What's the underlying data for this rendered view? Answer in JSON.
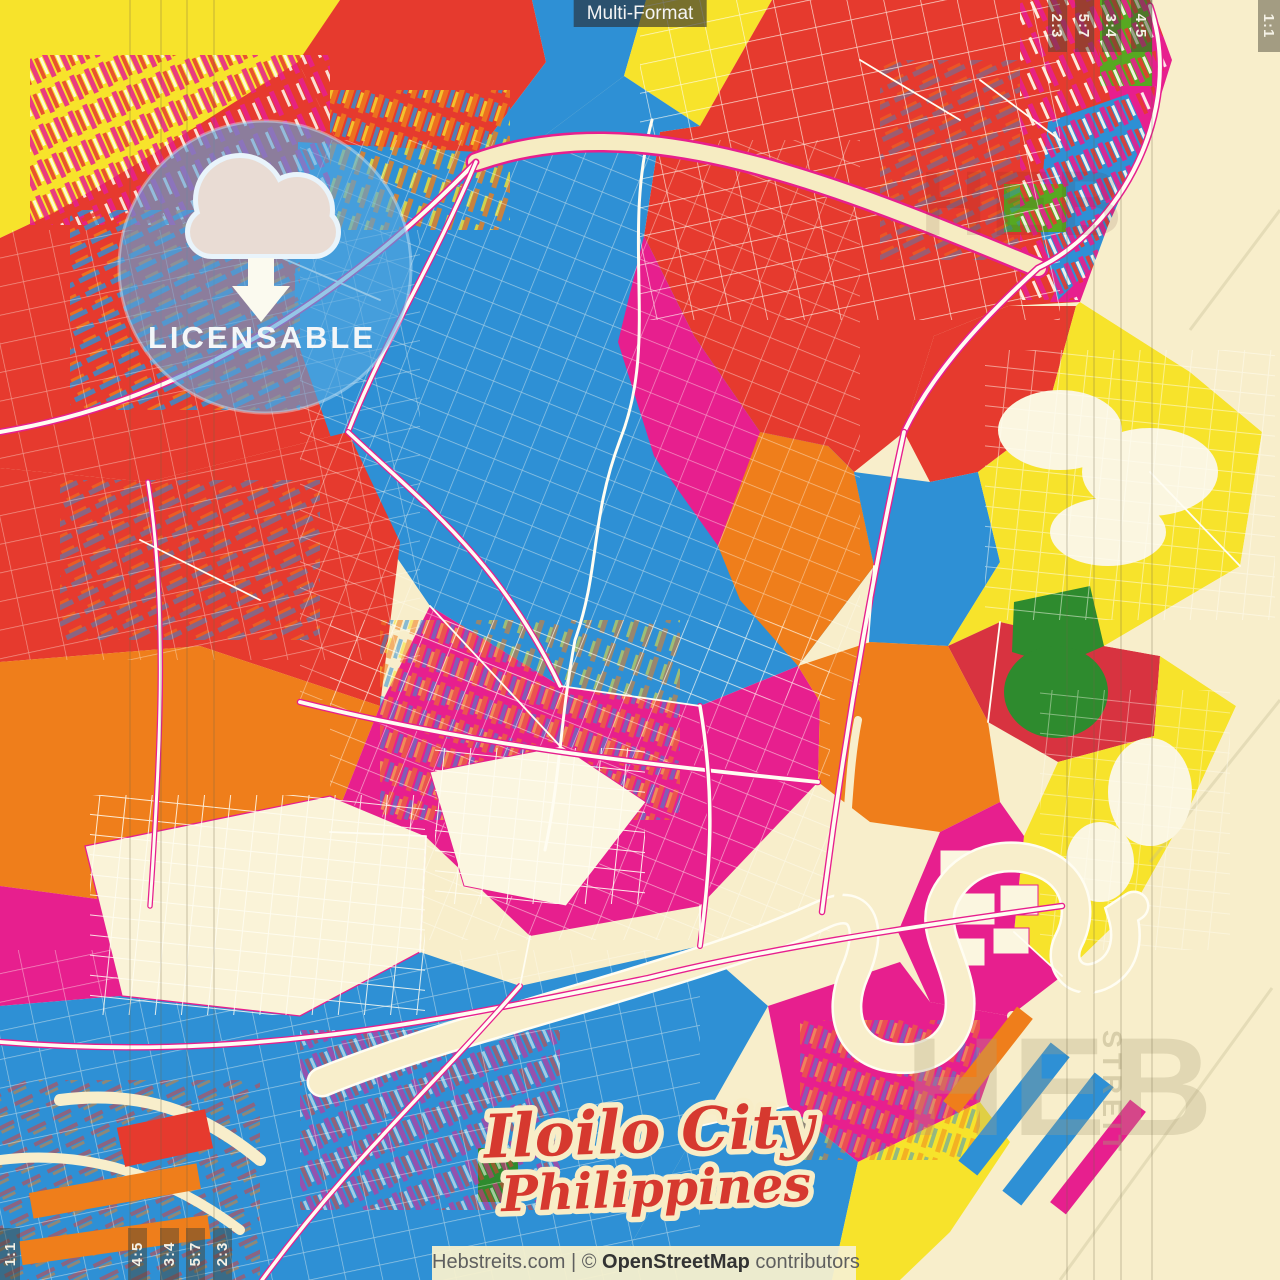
{
  "header": {
    "format_label": "Multi-Format"
  },
  "badge": {
    "label": "LICENSABLE",
    "icon": "cloud-download-icon"
  },
  "map_title": {
    "city": "Iloilo City",
    "country": "Philippines"
  },
  "attribution": {
    "site": "Hebstreits.com",
    "separator": "|",
    "copyright": "©",
    "osm": "OpenStreetMap",
    "contributors": "contributors"
  },
  "format_markers": {
    "top_right": [
      "2:3",
      "5:7",
      "3:4",
      "4:5",
      "1:1"
    ],
    "bottom_left": [
      "1:1",
      "4:5",
      "3:4",
      "5:7",
      "2:3"
    ]
  },
  "watermarks": {
    "brand_fragment_large": "HEB",
    "brand_fragment_vertical": "STREIT",
    "brand_fragment_faint": "HEB"
  },
  "palette": {
    "red": "#e63a2e",
    "crimson": "#d83340",
    "magenta": "#e71f8e",
    "blue": "#2e90d5",
    "orange": "#ef7e1b",
    "yellow": "#f7e32b",
    "green": "#2e8b2e",
    "cream_water": "#f8eecb",
    "street_white": "#fffdf2",
    "badge_blue": "#54a7e0",
    "title_red": "#d6392f",
    "chip_bg": "#2a2a2e",
    "attribution_bg": "#f7f0ce"
  }
}
